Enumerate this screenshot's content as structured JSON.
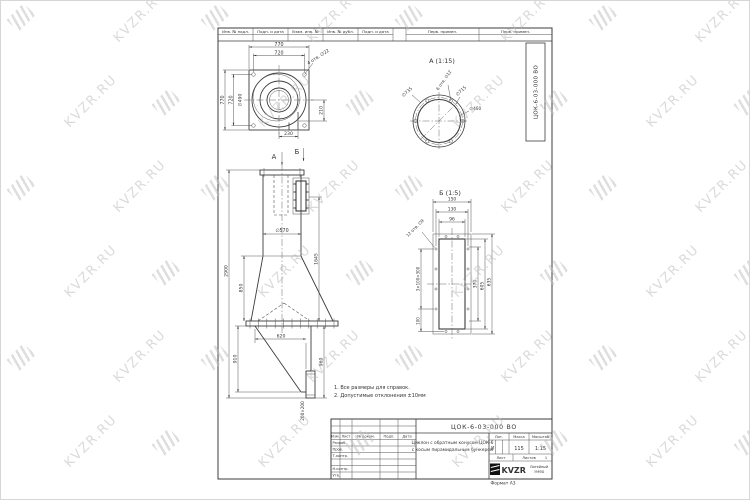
{
  "watermark": {
    "text": "KVZR.RU"
  },
  "frame": {
    "format_label": "Формат А3"
  },
  "top_strip": {
    "cells": [
      "Инв. № подл.",
      "Подп. и дата",
      "Взам. инв. №",
      "Инв. № дубл.",
      "Подп. и дата"
    ],
    "right_cells": [
      "Перв. примен.",
      "Перв. примен."
    ]
  },
  "doc_number": "ЦОК-6-03-000 ВО",
  "plan_view": {
    "dim_top_outer": "770",
    "dim_top_inner": "720",
    "dim_left_outer": "770",
    "dim_left_inner": "720",
    "dim_diameter": "∅490",
    "dim_right": "210",
    "dim_bottom": "230",
    "holes_label": "4 отв. ∅22"
  },
  "section_marks": {
    "a": "А",
    "b": "Б"
  },
  "front_view": {
    "dim_total_height": "2900",
    "dim_cone_height": "850",
    "dim_pipe_diameter": "∅570",
    "dim_right_height": "1645",
    "dim_bunker_left": "910",
    "dim_bunker_right": "960",
    "dim_bunker_width": "620",
    "dim_outlet": "200×200"
  },
  "view_a": {
    "title": "А (1:15)",
    "dim_outer": "∅735",
    "dim_bolt_circle": "∅715",
    "holes_label": "6 отв. ∅12",
    "dim_inner": "∅460"
  },
  "view_b": {
    "title": "Б (1:5)",
    "dim_width_outer": "150",
    "dim_width_bolt": "130",
    "dim_width_inner": "96",
    "holes_label": "12 отв. ∅9",
    "dim_pitch": "3×100=300",
    "dim_bottom": "100",
    "dim_h_inner": "370",
    "dim_h_mid": "605",
    "dim_h_outer": "635"
  },
  "notes": {
    "line1": "1. Все размеры для справок.",
    "line2": "2. Допустимые отклонения ±10мм"
  },
  "stamp": {
    "designation": "ЦОК-6-03-000 ВО",
    "col_izm": "Изм.",
    "col_list": "Лист",
    "col_doc": "№ докум.",
    "col_podp": "Подп.",
    "col_data": "Дата",
    "row_razrab": "Разраб.",
    "row_prov": "Пров.",
    "row_tkontr": "Т.контр.",
    "row_nkontr": "Н.контр.",
    "row_utv": "Утв.",
    "title_line1": "Циклон с обратным конусом ЦОК-6",
    "title_line2": "с косым пирамидальным бункером",
    "lit_header": "Лит.",
    "mass_header": "Масса",
    "scale_header": "Масштаб",
    "lit_value": "И",
    "mass_value": "115",
    "scale_value": "1:15",
    "sheet_label": "Лист",
    "sheets_label": "Листов",
    "sheets_value": "1",
    "logo_text": "KVZR",
    "factory_line1": "Литейный",
    "factory_line2": "завод"
  }
}
